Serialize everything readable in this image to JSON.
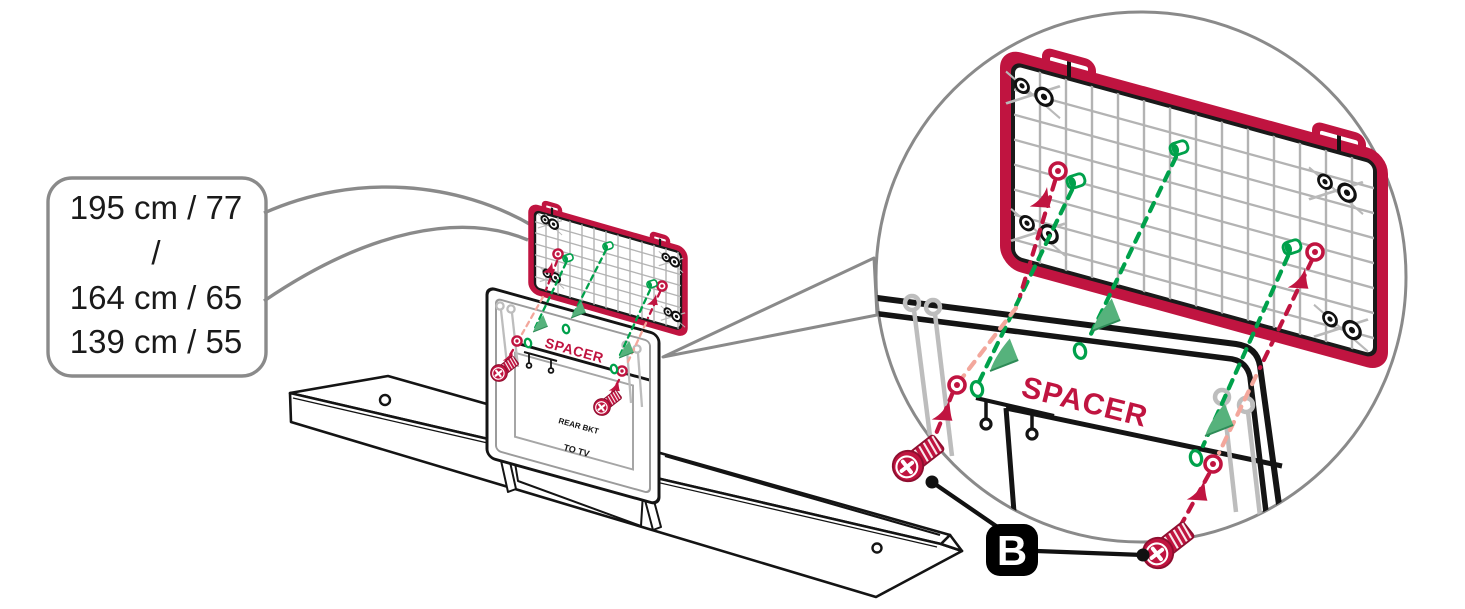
{
  "callout": {
    "lines": [
      "195 cm / 77",
      "/",
      "164 cm / 65",
      "139 cm / 55"
    ]
  },
  "bracket": {
    "spacer_label": "SPACER",
    "rear_bkt_label": "REAR BKT",
    "to_tv_label": "TO TV"
  },
  "zoom_view": {
    "spacer_label": "SPACER"
  },
  "part": {
    "label": "B"
  },
  "colors": {
    "accent_red": "#C01440",
    "green": "#00A14B",
    "green_light": "#56B27C",
    "salmon_faded": "#F3A79C",
    "leader_gray": "#8A8A8A",
    "grid_gray": "#B3B3B3",
    "pin_gray": "#BDBDBD",
    "ink": "#141414"
  }
}
